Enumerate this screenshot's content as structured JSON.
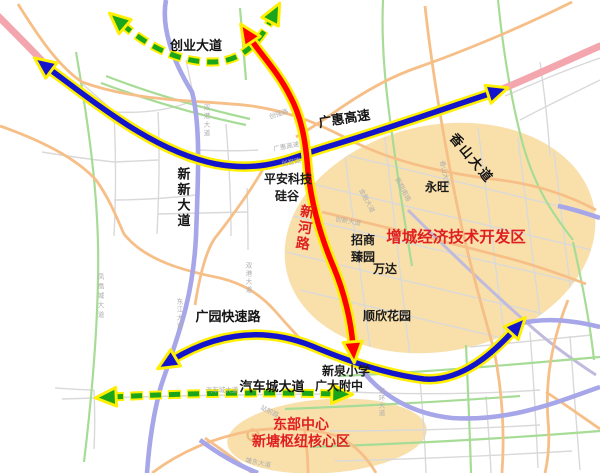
{
  "colors": {
    "arrow_blue": "#1414cc",
    "arrow_red": "#fe0000",
    "arrow_green": "#1ba51b",
    "arrow_casing": "#ffef00",
    "zone_fill": "#f9e0ab",
    "zone_text": "#e02020",
    "road_orange": "#f6bf87",
    "road_green": "#a7dc96",
    "road_purple": "#a6a6e8",
    "road_pink": "#f3a6ad",
    "road_gray": "#d9d9d9"
  },
  "corridors": {
    "chuangye_dadao": "创业大道",
    "guanghui_gaosu": "广惠高速",
    "xinxin_dadao": "新新大道",
    "guangyuan_kuaisulu": "广园快速路",
    "qichecheng_dadao": "汽车城大道",
    "xinhe_lu": "新河路",
    "xiangshan_dadao": "香山大道"
  },
  "zones": {
    "kaifaqu": "增城经济技术开发区",
    "dongbu_line1": "东部中心",
    "dongbu_line2": "新塘枢纽核心区"
  },
  "places": {
    "pingan_keji": "平安科技",
    "guigu": "硅谷",
    "yongwang": "永旺",
    "zhaoshang": "招商",
    "zhenyuan": "臻园",
    "wanda": "万达",
    "shunxin_huayuan": "顺欣花园",
    "xinquan_xiaoxue": "新泉小学",
    "guangda_fuzhong": "广大附中"
  },
  "minor_roads": {
    "shuanggang_dadao": "双港大道",
    "shuanggang_dadao_s": "双港大道",
    "fenghuangcheng_dadao": "凤凰城大道",
    "dongjiang_dadao": "东江大道",
    "donghuan_dadao": "东环大道",
    "chuangqiang_lu": "创强路",
    "guanghui_gaosu_s": "广惠高速",
    "chuangyu_lu": "创誉路",
    "jinrong_dadao": "金融大道",
    "xinxiang_nanlu": "新翔南路",
    "xiangshan_dadao_s": "香山大道",
    "chuangxin_dadao": "创新大道",
    "qichecheng_dadao_s": "汽车城大道",
    "zhanqian_lu": "站前路",
    "tangdong_dadao": "塘东大道"
  }
}
